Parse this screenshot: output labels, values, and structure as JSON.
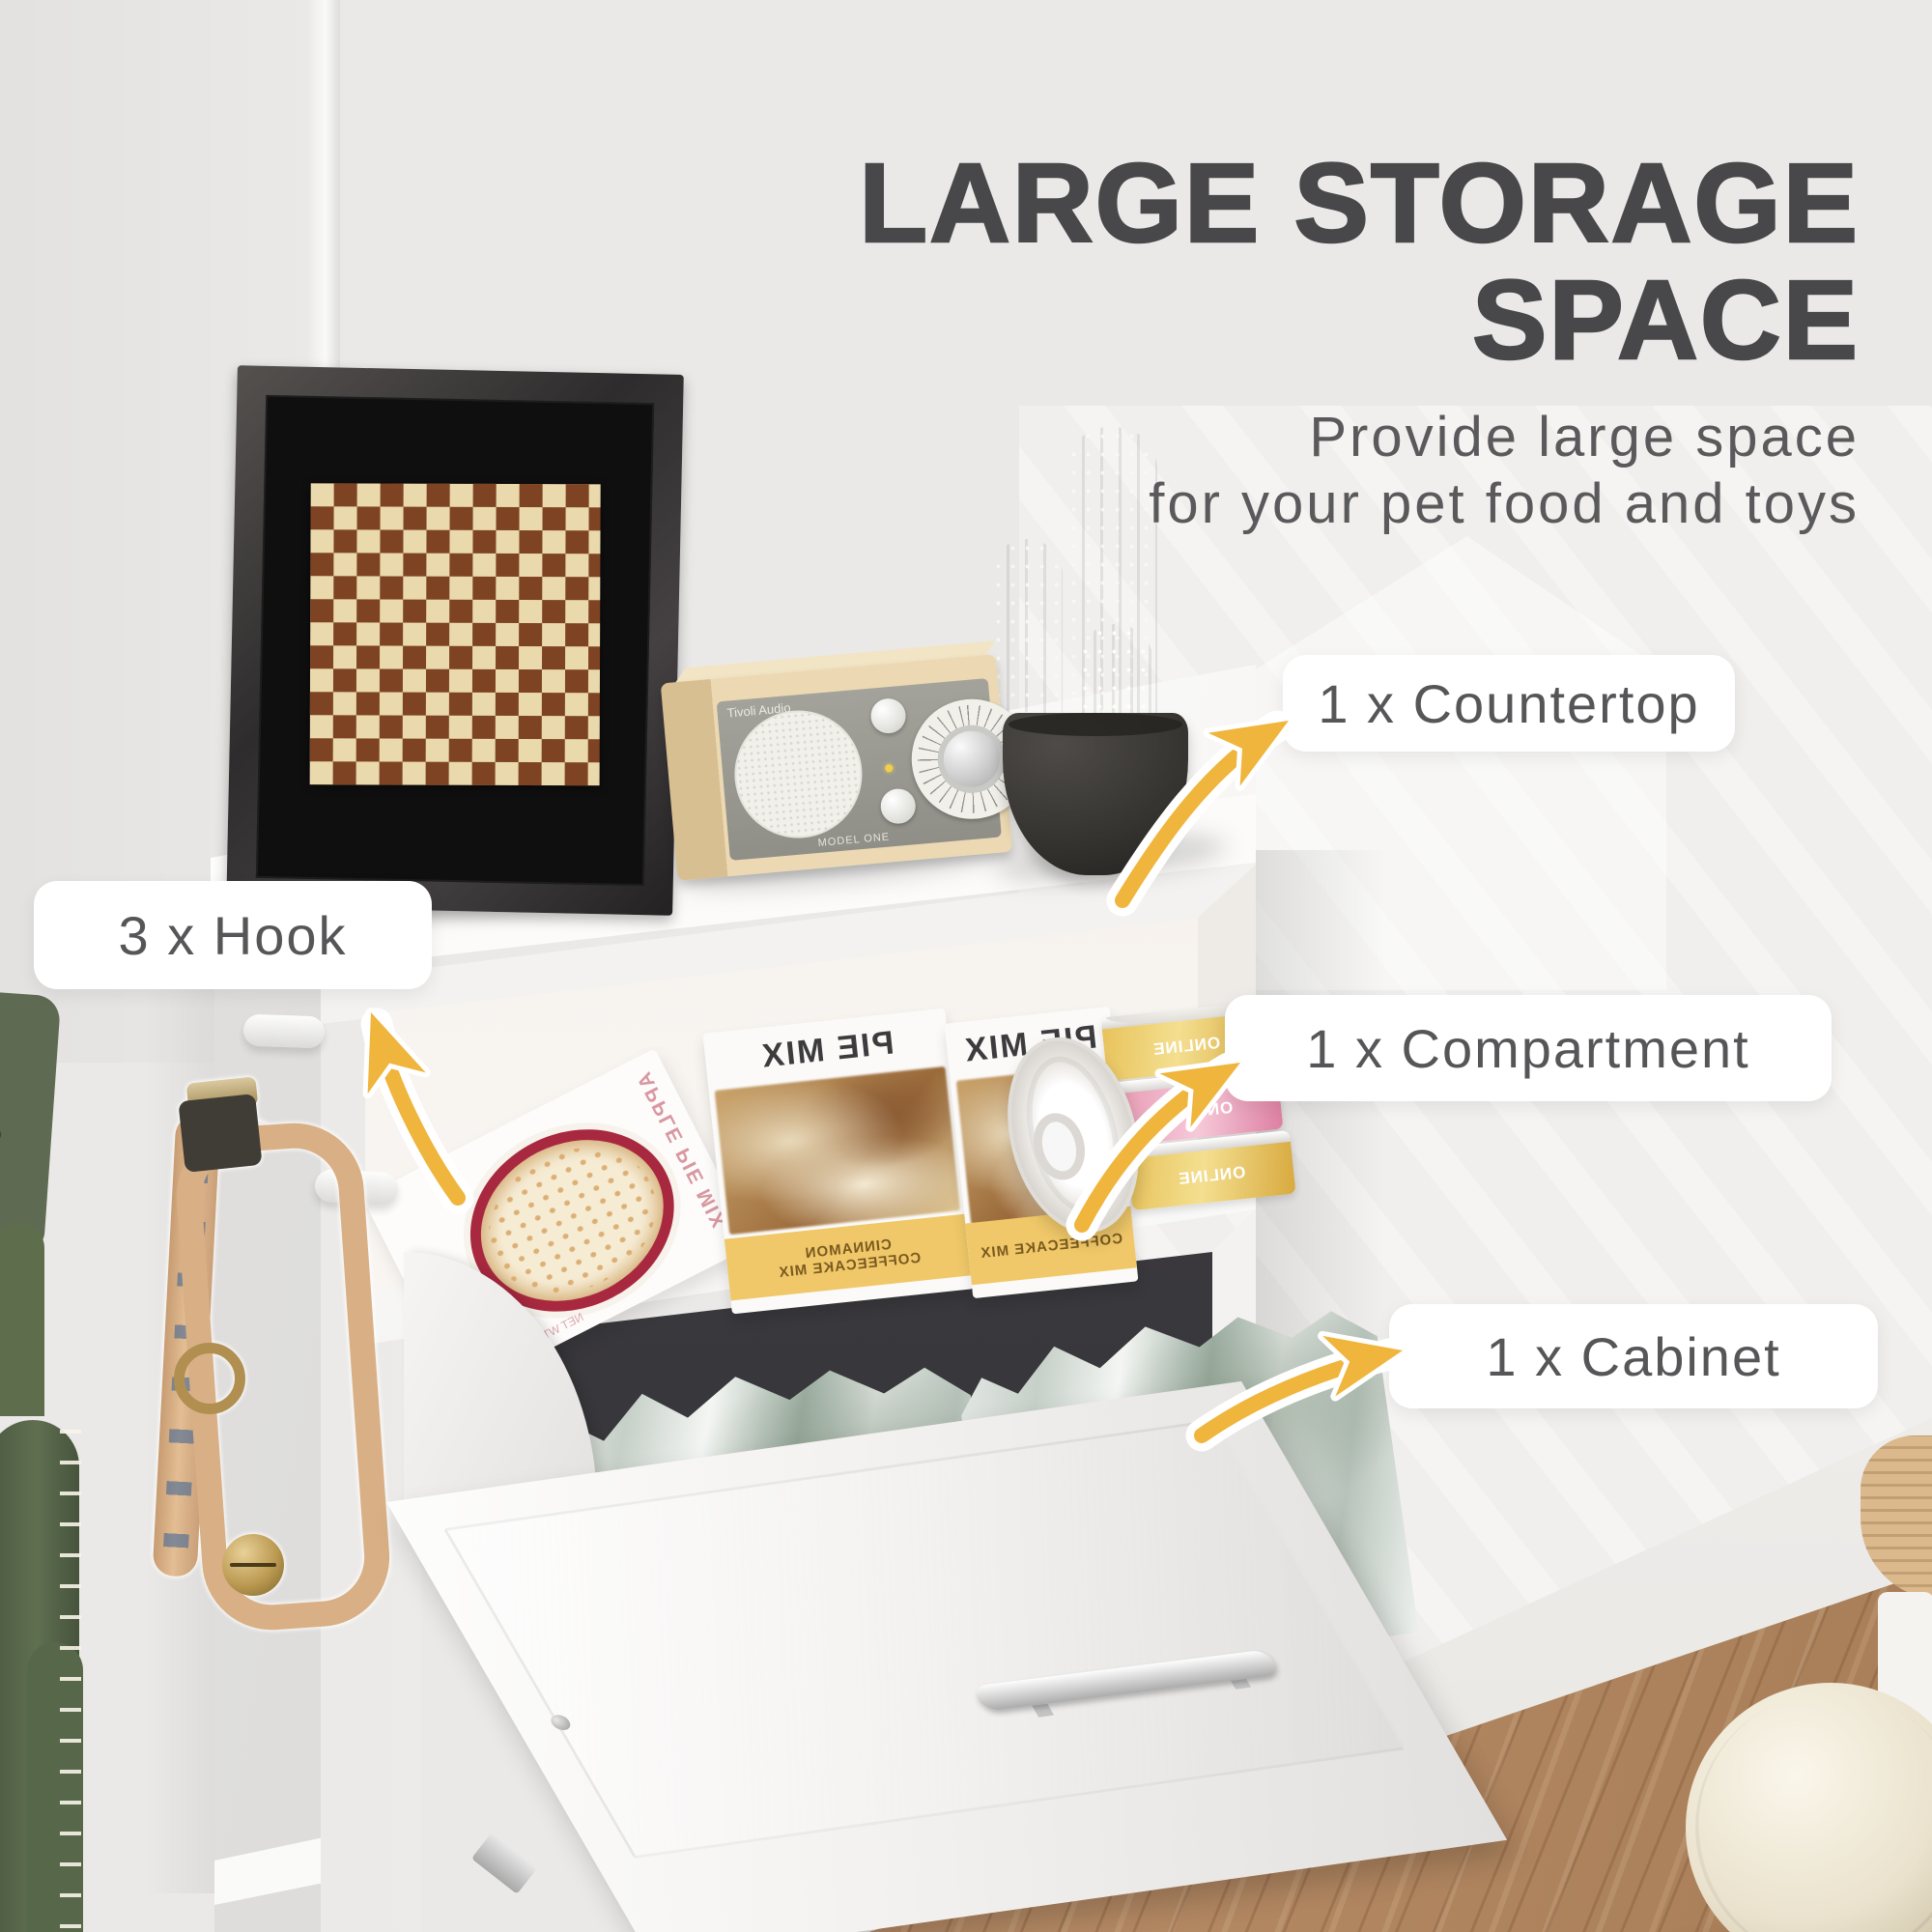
{
  "header": {
    "title_line1": "LARGE STORAGE",
    "title_line2": "SPACE",
    "subtitle_line1": "Provide large space",
    "subtitle_line2": "for your pet food and toys"
  },
  "callouts": {
    "countertop": "1 x Countertop",
    "hook": "3 x Hook",
    "compartment": "1 x Compartment",
    "cabinet": "1 x Cabinet"
  },
  "colors": {
    "arrow_gold": "#EFB53C",
    "title_text": "#48484A",
    "callout_text": "#565658",
    "pill_bg": "#FFFFFF",
    "wall": "#EAE9E7",
    "floor_wood": "#B98E69",
    "checker_brown": "#7E4322",
    "checker_cream": "#EAD9AD"
  },
  "products": {
    "radio_brand": "Tivoli Audio",
    "radio_model": "MODEL ONE",
    "pie_box_title": "PIE MIX",
    "pie_box_band_line1": "CINNAMON",
    "pie_box_band_line2": "COFFEECAKE MIX",
    "apple_box_title": "APPLE PIE MIX",
    "apple_box_weight": "NET WT. 12.4 OZ. (352g)",
    "can_label": "ONLINE",
    "bag_word_1": "i love",
    "bag_word_2": "ples",
    "bag_word_3": "utri"
  }
}
